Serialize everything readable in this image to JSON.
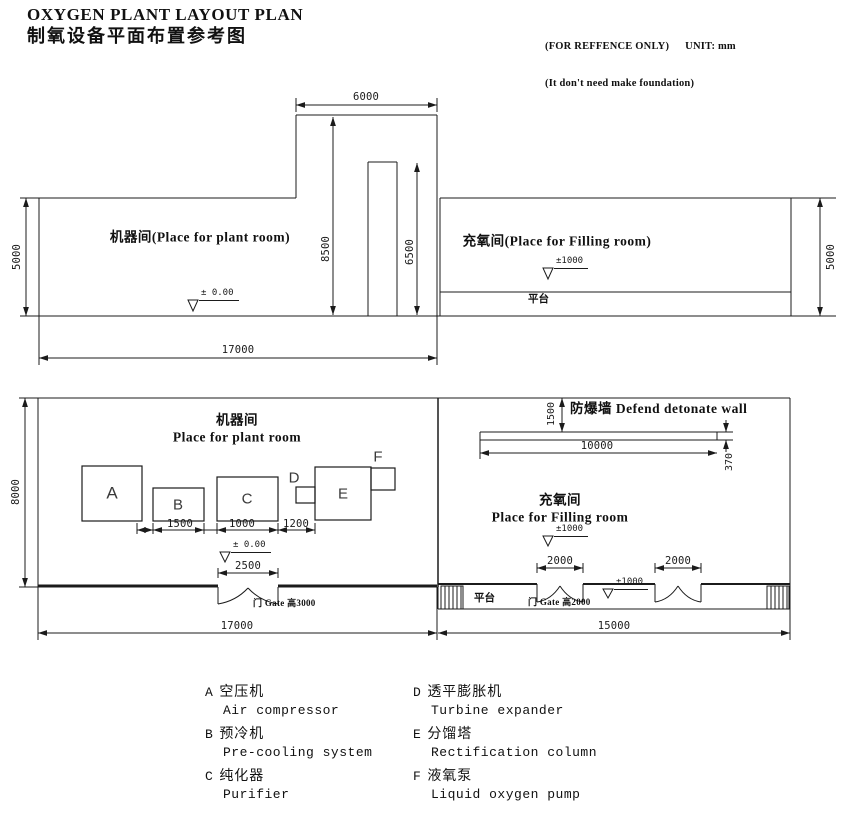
{
  "header": {
    "title_en": "OXYGEN PLANT LAYOUT PLAN",
    "title_cn": "制氧设备平面布置参考图",
    "note_reference": "(FOR REFFENCE ONLY)",
    "note_unit": "UNIT: mm",
    "note_foundation": "(It don't need make foundation)"
  },
  "elevation": {
    "plant_room_label": "机器间(Place for plant room)",
    "filling_room_label": "充氧间(Place for Filling room)",
    "platform_label": "平台",
    "level_zero": "± 0.00",
    "level_1000": "±1000",
    "dims": {
      "tower_width": "6000",
      "tower_height": "8500",
      "column_height": "6500",
      "left_height": "5000",
      "right_height": "5000",
      "plant_width": "17000"
    }
  },
  "plan": {
    "plant_room_cn": "机器间",
    "plant_room_en": "Place for plant room",
    "filling_room_cn": "充氧间",
    "filling_room_en": "Place for Filling room",
    "wall_label": "防爆墙 Defend detonate wall",
    "platform_label": "平台",
    "gate_plant": "门 Gate 高3000",
    "gate_filling": "门 Gate 高2000",
    "level_zero": "± 0.00",
    "level_1000": "±1000",
    "level_1000_platform": "±1000",
    "equipment": {
      "a": "A",
      "b": "B",
      "c": "C",
      "d": "D",
      "e": "E",
      "f": "F"
    },
    "dims": {
      "plant_height": "8000",
      "gap_ab": "1500",
      "gap_bc": "1000",
      "gap_ce": "1200",
      "gate_width": "2500",
      "plant_width": "17000",
      "filling_width": "15000",
      "wall_offset": "1500",
      "wall_length": "10000",
      "wall_thickness": "370",
      "door1_width": "2000",
      "door2_width": "2000"
    }
  },
  "legend": {
    "items": [
      {
        "key": "A",
        "cn": "空压机",
        "en": "Air compressor"
      },
      {
        "key": "B",
        "cn": "预冷机",
        "en": "Pre-cooling system"
      },
      {
        "key": "C",
        "cn": "纯化器",
        "en": "Purifier"
      },
      {
        "key": "D",
        "cn": "透平膨胀机",
        "en": "Turbine expander"
      },
      {
        "key": "E",
        "cn": "分馏塔",
        "en": "Rectification column"
      },
      {
        "key": "F",
        "cn": "液氧泵",
        "en": "Liquid oxygen pump"
      }
    ]
  }
}
